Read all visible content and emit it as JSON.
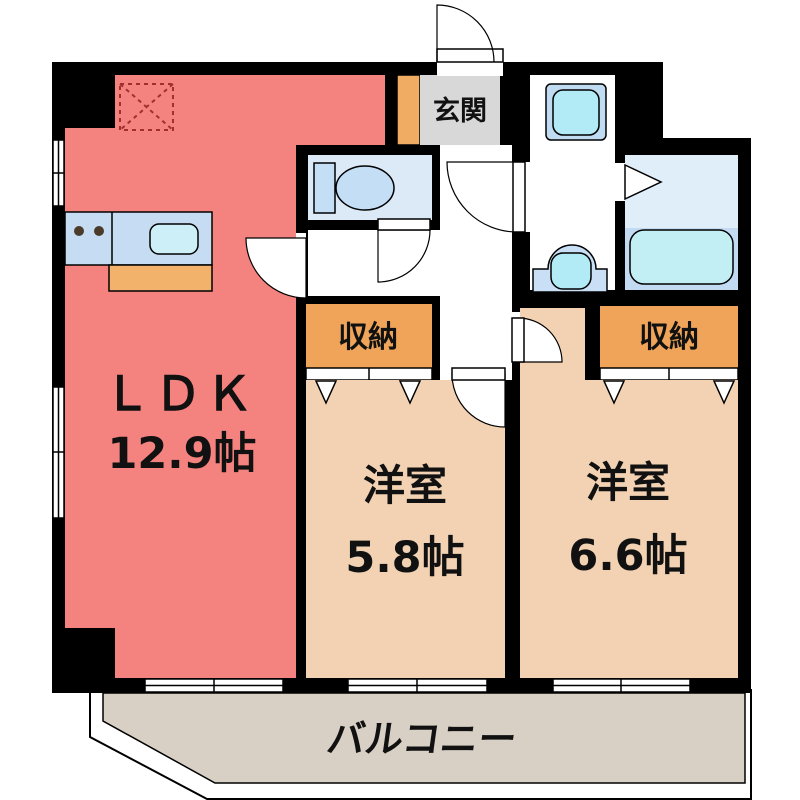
{
  "plan": {
    "type": "apartment-floor-plan",
    "rooms": {
      "ldk": {
        "name": "ＬＤＫ",
        "area": "12.9帖"
      },
      "bedroom_a": {
        "name": "洋室",
        "area": "5.8帖"
      },
      "bedroom_b": {
        "name": "洋室",
        "area": "6.6帖"
      },
      "entrance": {
        "name": "玄関"
      },
      "storage_a": {
        "name": "収納"
      },
      "storage_b": {
        "name": "収納"
      },
      "balcony": {
        "name": "バルコニー"
      }
    },
    "fixtures": [
      "refrigerator-space",
      "kitchen-counter",
      "stove-burners",
      "kitchen-sink",
      "toilet",
      "washing-machine-pan",
      "washbasin",
      "bathtub",
      "bath-folding-door",
      "entrance-door",
      "closet-folding-doors",
      "sliding-windows"
    ],
    "colors": {
      "wall": "#000000",
      "ldk_floor": "#F4827F",
      "bedroom_floor": "#F2D2B2",
      "storage": "#EFA459",
      "accent_orange": "#F0AC63",
      "entrance_floor": "#D8D8D8",
      "balcony_floor": "#D8CFC5",
      "water_room_floor": "#DCEAF8",
      "fixture_blue": "#C4DEF5",
      "fixture_cyan": "#B2EBF5",
      "bath_lower_floor": "#C3DBF2",
      "bath_upper_floor": "#E0EEF9"
    }
  }
}
